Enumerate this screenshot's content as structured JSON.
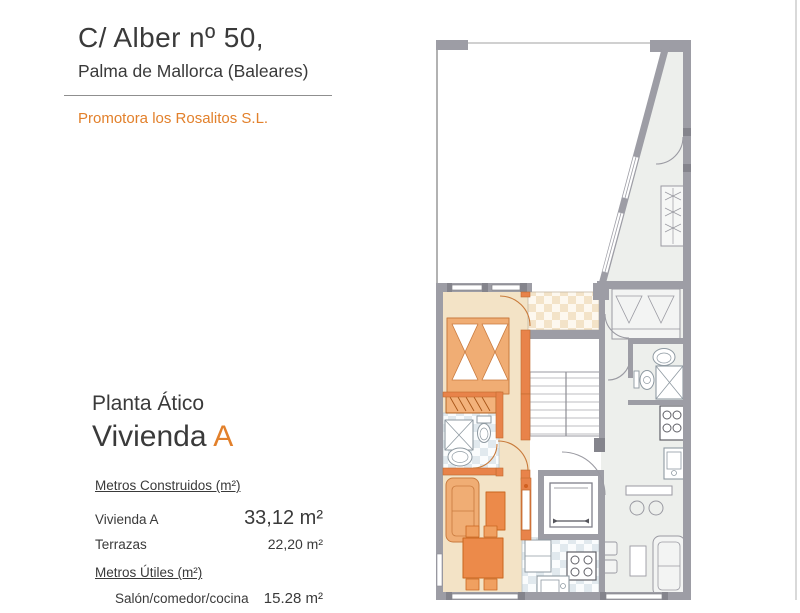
{
  "document": {
    "address_line1": "C/ Alber nº 50,",
    "address_line2": "Palma de Mallorca (Baleares)",
    "promoter": "Promotora los Rosalitos S.L.",
    "floor_label": "Planta Ático",
    "unit_label_prefix": "Vivienda",
    "unit_letter": "A"
  },
  "measurements": {
    "built": {
      "heading": "Metros Construidos (m²)",
      "rows": [
        {
          "label": "Vivienda A",
          "value": "33,12 m²"
        },
        {
          "label": "Terrazas",
          "value": "22,20 m²"
        }
      ]
    },
    "useful": {
      "heading": "Metros Útiles (m²)",
      "rows": [
        {
          "label": "Salón/comedor/cocina",
          "value": "15.28 m²"
        }
      ]
    }
  },
  "floor_plan": {
    "elements": [
      "terrace",
      "bedroom",
      "wardrobe",
      "bathroom",
      "hall",
      "living-dining",
      "kitchen",
      "tiled-terrace",
      "staircase",
      "elevator",
      "adjacent-unit-bedroom",
      "adjacent-unit-bathroom",
      "adjacent-unit-kitchen",
      "adjacent-unit-living"
    ],
    "colors": {
      "unit_a_floor": "#f3e3c6",
      "unit_a_furniture_light": "#f0ad74",
      "unit_a_furniture_dark": "#ec8a4a",
      "unit_a_wall": "#e8834a",
      "adjacent_floor": "#edefec",
      "wall_gray": "#9d9da5",
      "jamb_dark": "#84848c",
      "accent_orange": "#e2802b",
      "text": "#3a3a3a"
    }
  }
}
